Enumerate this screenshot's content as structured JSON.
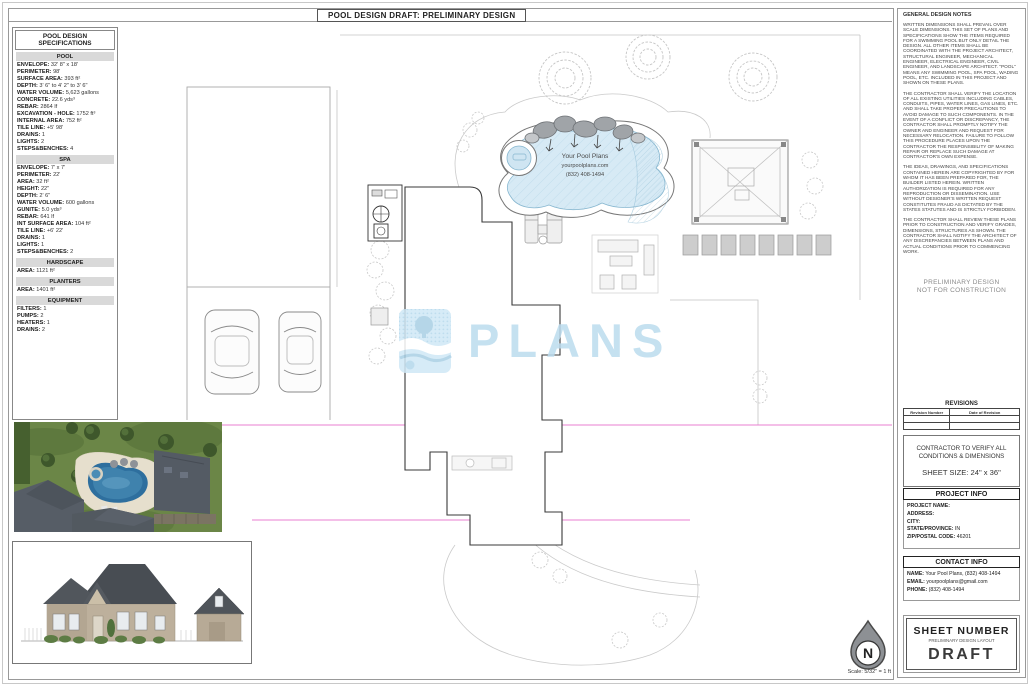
{
  "title": "POOL DESIGN DRAFT: PRELIMINARY DESIGN",
  "colors": {
    "pool_water": "#d7eaf5",
    "watermark_blue": "#bcdcee",
    "magenta_line": "#e87fd0",
    "section_header_gray": "#d9d9d9"
  },
  "specs": {
    "title": "POOL DESIGN SPECIFICATIONS",
    "sections": [
      {
        "header": "POOL",
        "items": [
          {
            "label": "ENVELOPE:",
            "value": "32' 8\" x 18'"
          },
          {
            "label": "PERIMETER:",
            "value": "98'"
          },
          {
            "label": "SURFACE AREA:",
            "value": "393 ft²"
          },
          {
            "label": "DEPTH:",
            "value": "3' 6\" to 4' 2\" to 3' 6\""
          },
          {
            "label": "WATER VOLUME:",
            "value": "5,623 gallons"
          },
          {
            "label": "CONCRETE:",
            "value": "22.6 yds³"
          },
          {
            "label": "REBAR:",
            "value": "2864 lf"
          },
          {
            "label": "EXCAVATION - HOLE:",
            "value": "1752 ft³"
          },
          {
            "label": "INTERNAL AREA:",
            "value": "752 ft²"
          },
          {
            "label": "TILE LINE:",
            "value": "+5' 98'"
          },
          {
            "label": "DRAINS:",
            "value": "1"
          },
          {
            "label": "LIGHTS:",
            "value": "2"
          },
          {
            "label": "STEPS&BENCHES:",
            "value": "4"
          }
        ]
      },
      {
        "header": "SPA",
        "items": [
          {
            "label": "ENVELOPE:",
            "value": "7' x 7'"
          },
          {
            "label": "PERIMETER:",
            "value": "22'"
          },
          {
            "label": "AREA:",
            "value": "32 ft²"
          },
          {
            "label": "HEIGHT:",
            "value": "22\""
          },
          {
            "label": "DEPTH:",
            "value": "2' 6\""
          },
          {
            "label": "WATER VOLUME:",
            "value": "600 gallons"
          },
          {
            "label": "GUNITE:",
            "value": "5.0 yds³"
          },
          {
            "label": "REBAR:",
            "value": "641 lf"
          },
          {
            "label": "INT SURFACE AREA:",
            "value": "104 ft²"
          },
          {
            "label": "TILE LINE:",
            "value": "+6' 22'"
          },
          {
            "label": "DRAINS:",
            "value": "1"
          },
          {
            "label": "LIGHTS:",
            "value": "1"
          },
          {
            "label": "STEPS&BENCHES:",
            "value": "2"
          }
        ]
      },
      {
        "header": "HARDSCAPE",
        "items": [
          {
            "label": "AREA:",
            "value": "1121 ft²"
          }
        ]
      },
      {
        "header": "PLANTERS",
        "items": [
          {
            "label": "AREA:",
            "value": "1401 ft²"
          }
        ]
      },
      {
        "header": "EQUIPMENT",
        "items": [
          {
            "label": "FILTERS:",
            "value": "1"
          },
          {
            "label": "PUMPS:",
            "value": "2"
          },
          {
            "label": "HEATERS:",
            "value": "1"
          },
          {
            "label": "DRAINS:",
            "value": "2"
          }
        ]
      }
    ]
  },
  "site_plan": {
    "pool_label": [
      "Your Pool Plans",
      "yourpoolplans.com",
      "(832) 408-1494"
    ]
  },
  "watermark": {
    "text": "PLANS"
  },
  "notes": {
    "title": "GENERAL DESIGN NOTES",
    "paragraphs": [
      "WRITTEN DIMENSIONS SHALL PREVAIL OVER SCALE DIMENSIONS. THIS SET OF PLANS AND SPECIFICATIONS SHOW THE ITEMS REQUIRED FOR A SWIMMING POOL BUT ONLY DETAIL THE DESIGN. ALL OTHER ITEMS SHALL BE COORDINATED WITH THE PROJECT ARCHITECT, STRUCTURAL ENGINEER, MECHANICAL ENGINEER, ELECTRICAL ENGINEER, CIVIL ENGINEER, AND LANDSCAPE ARCHITECT. \"POOL\" MEANS ANY SWIMMING POOL, SPA POOL, WADING POOL, ETC. INCLUDED IN THIS PROJECT AND SHOWN ON THESE PLANS.",
      "THE CONTRACTOR SHALL VERIFY THE LOCATION OF ALL EXISTING UTILITIES INCLUDING CABLES, CONDUITS, PIPES, WATER LINES, GAS LINES, ETC. AND SHALL TAKE PROPER PRECAUTIONS TO AVOID DAMAGE TO SUCH COMPONENTS. IN THE EVENT OF A CONFLICT OR DISCREPANCY, THE CONTRACTOR SHALL PROMPTLY NOTIFY THE OWNER AND ENGINEER AND REQUEST FOR NECESSARY RELOCATION. FAILURE TO FOLLOW THIS PROCEDURE PLACES UPON THE CONTRACTOR THE RESPONSIBILITY OF MAKING REPAIR OR REPLACE SUCH DAMAGE AT CONTRACTOR'S OWN EXPENSE.",
      "THE IDEAS, DRAWINGS, AND SPECIFICATIONS CONTAINED HEREIN ARE COPYRIGHTED BY FOR WHOM IT HAS BEEN PREPARED FOR, THE BUILDER LISTED HEREIN. WRITTEN AUTHORIZATION IS REQUIRED FOR ANY REPRODUCTION OR DISSEMINATION. USE WITHOUT DESIGNER'S WRITTEN REQUEST CONSTITUTES FRAUD AS DICTATED BY THE STATES STATUTES AND IS STRICTLY FORBIDDEN.",
      "THE CONTRACTOR SHALL REVIEW THESE PLANS PRIOR TO CONSTRUCTION AND VERIFY GRADES, DIMENSIONS, STRUCTURES AS SHOWN. THE CONTRACTOR SHALL NOTIFY THE ARCHITECT OF ANY DISCREPANCIES BETWEEN PLANS AND ACTUAL CONDITIONS PRIOR TO COMMENCING WORK."
    ]
  },
  "stamp": {
    "lines": [
      "PRELIMINARY DESIGN",
      "NOT FOR CONSTRUCTION"
    ]
  },
  "revisions": {
    "title": "REVISIONS",
    "columns": [
      "Revision Number",
      "Date of Revision"
    ]
  },
  "verify_box": {
    "line1": "CONTRACTOR TO VERIFY ALL",
    "line2": "CONDITIONS & DIMENSIONS",
    "sheet_size": "SHEET SIZE:  24\" x 36\""
  },
  "project_info": {
    "title": "PROJECT INFO",
    "fields": [
      {
        "label": "PROJECT NAME:",
        "value": ""
      },
      {
        "label": "ADDRESS:",
        "value": ""
      },
      {
        "label": "CITY:",
        "value": ""
      },
      {
        "label": "STATE/PROVINCE:",
        "value": "IN"
      },
      {
        "label": "ZIP/POSTAL CODE:",
        "value": "46201"
      }
    ]
  },
  "contact_info": {
    "title": "CONTACT INFO",
    "fields": [
      {
        "label": "NAME:",
        "value": "Your Pool Plans, (832) 408-1494"
      },
      {
        "label": "EMAIL:",
        "value": "yourpoolplans@gmail.com"
      },
      {
        "label": "PHONE:",
        "value": "(832) 408-1494"
      }
    ]
  },
  "sheet_number": {
    "title": "SHEET NUMBER",
    "subtitle": "PRELIMINARY DESIGN LAYOUT",
    "value": "DRAFT"
  },
  "north": {
    "letter": "N",
    "scale": "Scale: 5/32\" = 1 ft"
  }
}
